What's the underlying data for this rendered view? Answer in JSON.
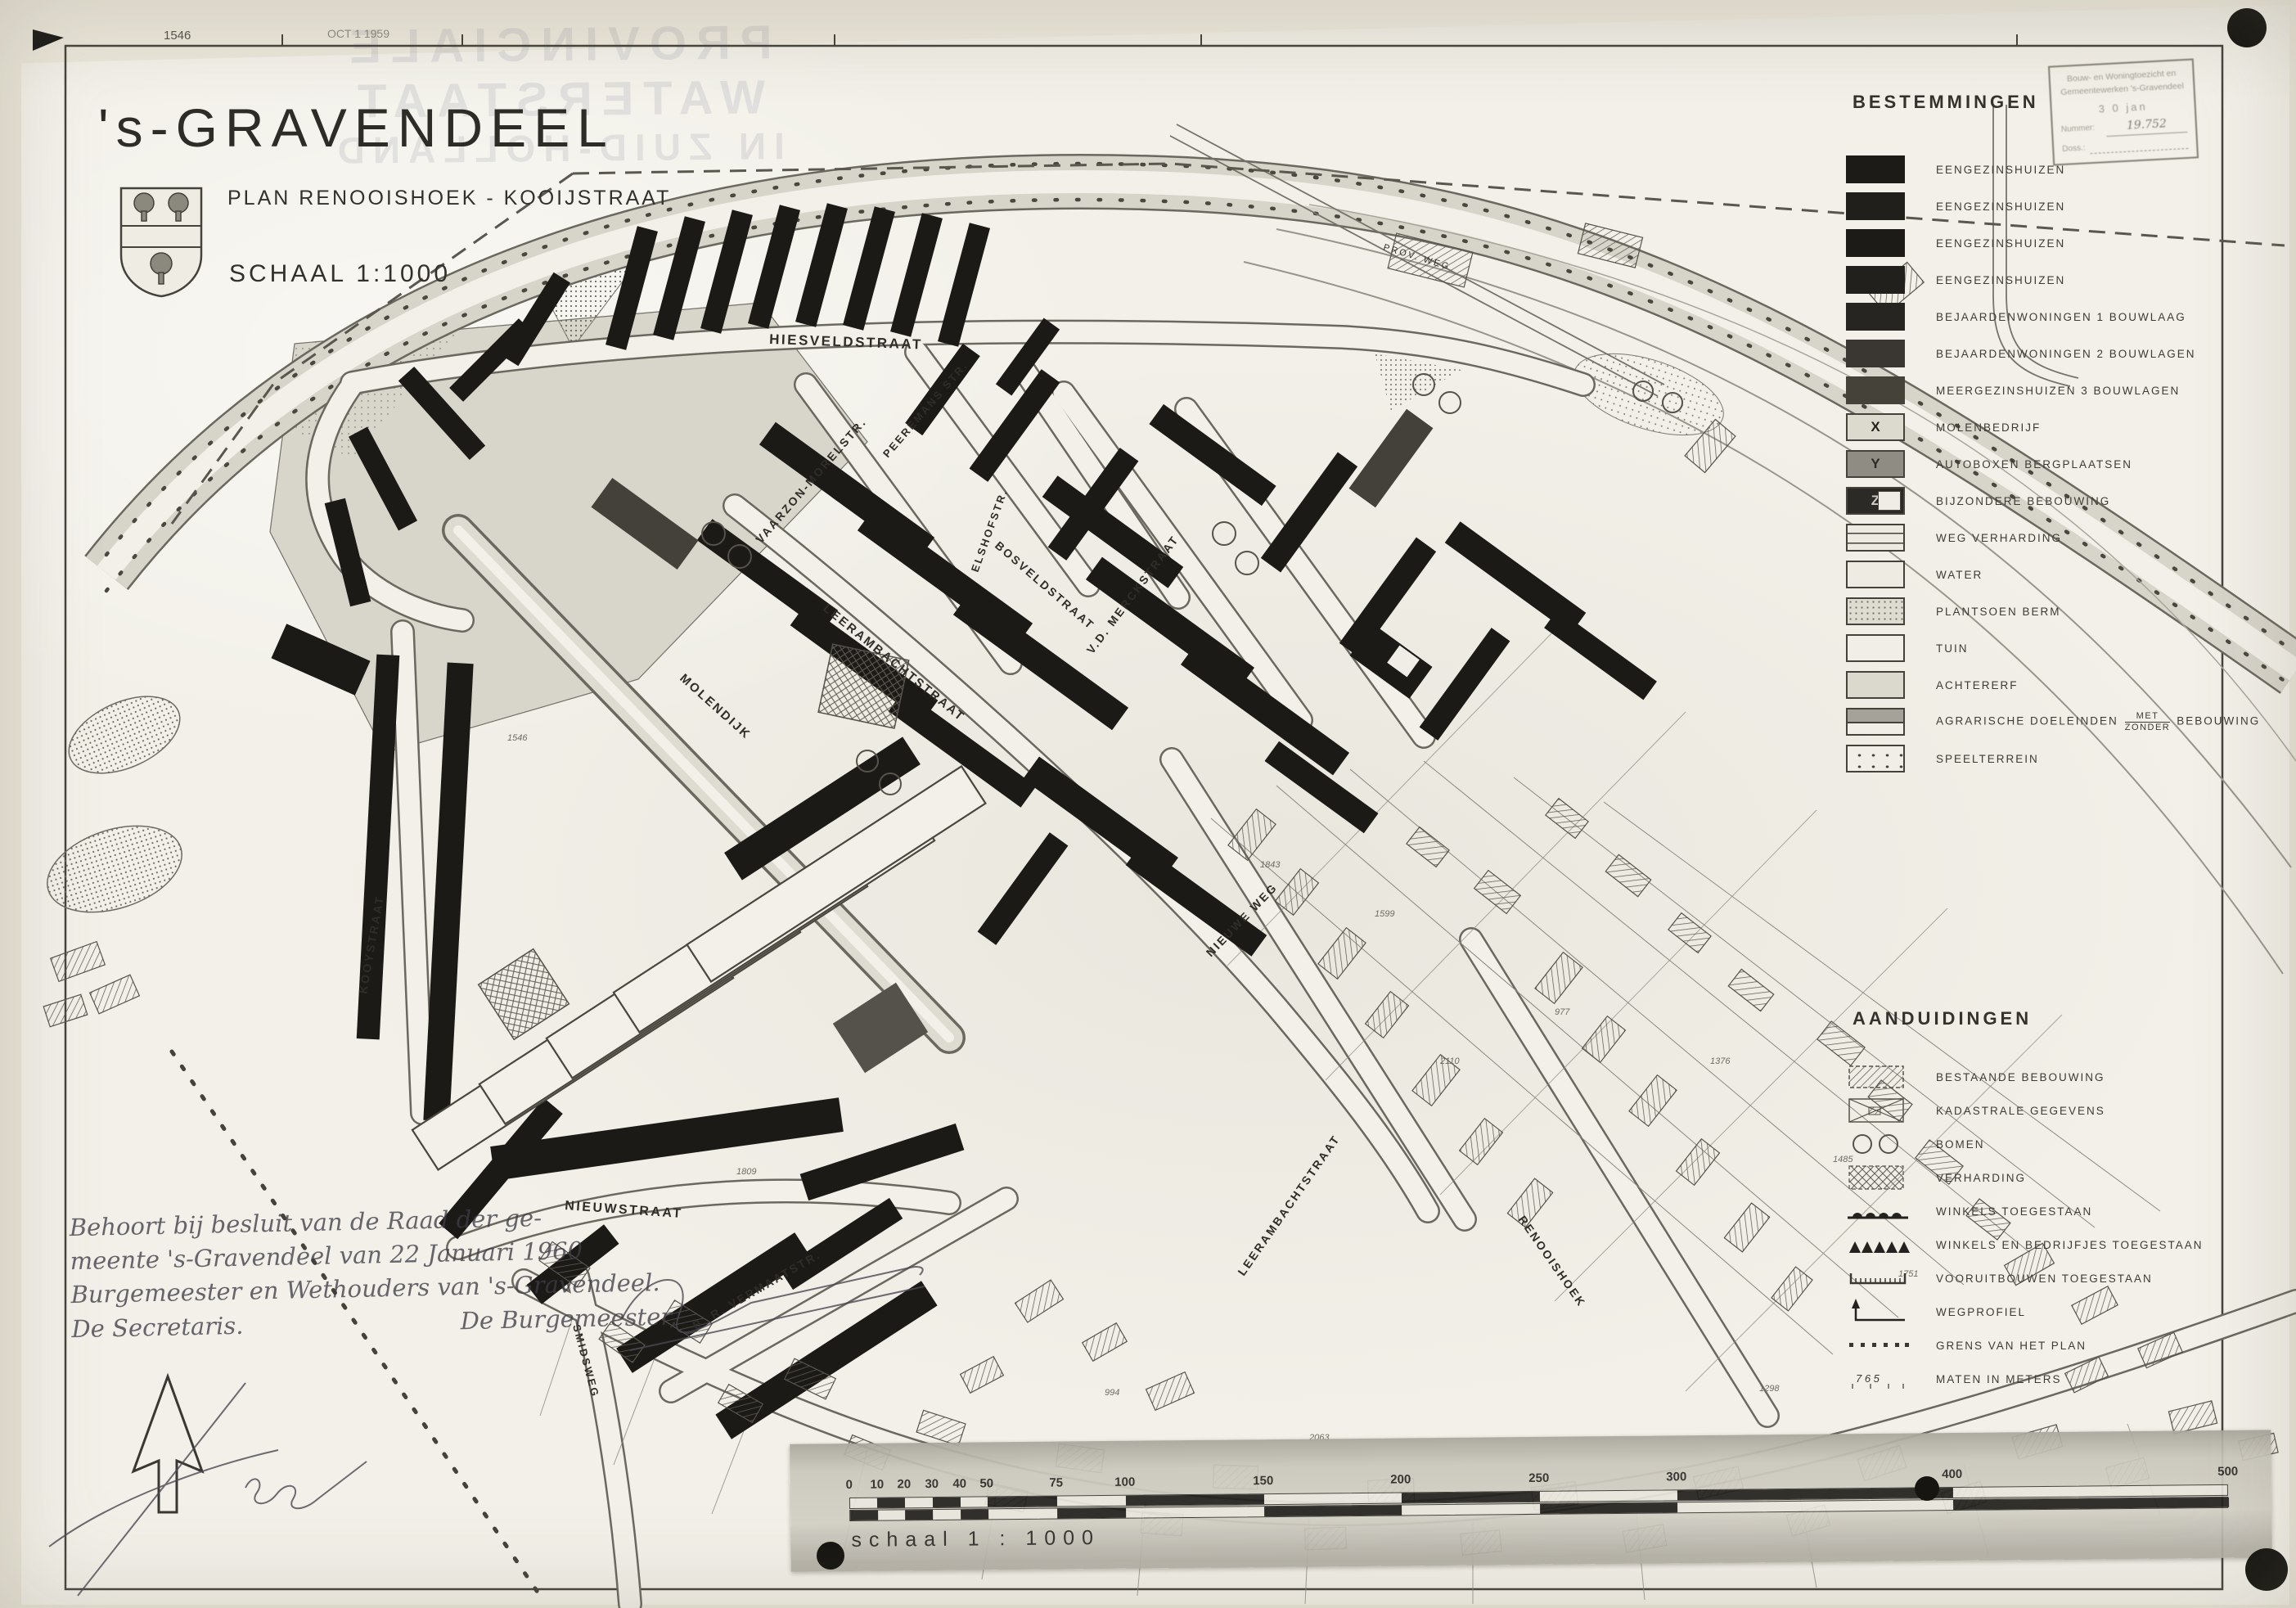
{
  "title_block": {
    "town": "'s-GRAVENDEEL",
    "plan": "PLAN RENOOISHOEK - KOOIJSTRAAT",
    "scale": "SCHAAL 1:1000"
  },
  "sheet_marks": {
    "ref": "1546",
    "date": "OCT 1 1959"
  },
  "ghost_text": {
    "line1": "PROVINCIALE WATERSTAAT",
    "line2": "IN ZUID-HOLLAND"
  },
  "stamp": {
    "line1": "Bouw- en Woningtoezicht en",
    "line2": "Gemeentewerken 's-Gravendeel",
    "date": "3 0 jan",
    "number_label": "Nummer:",
    "number": "19.752",
    "doss_label": "Doss.:"
  },
  "legend_bestemmingen": {
    "title": "BESTEMMINGEN",
    "items": [
      {
        "label": "EENGEZINSHUIZEN"
      },
      {
        "label": "EENGEZINSHUIZEN"
      },
      {
        "label": "EENGEZINSHUIZEN"
      },
      {
        "label": "EENGEZINSHUIZEN"
      },
      {
        "label": "BEJAARDENWONINGEN  1 BOUWLAAG"
      },
      {
        "label": "BEJAARDENWONINGEN  2 BOUWLAGEN"
      },
      {
        "label": "MEERGEZINSHUIZEN   3 BOUWLAGEN"
      },
      {
        "label": "MOLENBEDRIJF",
        "tag": "X"
      },
      {
        "label": "AUTOBOXEN  BERGPLAATSEN",
        "tag": "Y"
      },
      {
        "label": "BIJZONDERE  BEBOUWING",
        "tag": "Z"
      },
      {
        "label": "WEG  VERHARDING"
      },
      {
        "label": "WATER"
      },
      {
        "label": "PLANTSOEN  BERM"
      },
      {
        "label": "TUIN"
      },
      {
        "label": "ACHTERERF"
      },
      {
        "label": "AGRARISCHE  DOELEINDEN",
        "fraction_top": "MET",
        "fraction_bottom": "ZONDER",
        "suffix": "BEBOUWING"
      },
      {
        "label": "SPEELTERREIN"
      }
    ]
  },
  "legend_aanduidingen": {
    "title": "AANDUIDINGEN",
    "items": [
      {
        "label": "BESTAANDE  BEBOUWING"
      },
      {
        "label": "KADASTRALE  GEGEVENS"
      },
      {
        "label": "BOMEN"
      },
      {
        "label": "VERHARDING"
      },
      {
        "label": "WINKELS  TOEGESTAAN"
      },
      {
        "label": "WINKELS   EN BEDRIJFJES  TOEGESTAAN"
      },
      {
        "label": "VOORUITBOUWEN  TOEGESTAAN"
      },
      {
        "label": "WEGPROFIEL"
      },
      {
        "label": "GRENS  VAN  HET  PLAN"
      },
      {
        "label": "MATEN  IN  METERS",
        "ticks": "7  6  5"
      }
    ]
  },
  "streets": {
    "hiesveld": "HIESVELDSTRAAT",
    "vaarzon": "VAARZON-MORELSTR.",
    "peeremans": "PEEREMANS STR.",
    "elshof": "ELSHOFSTR.",
    "bosveld": "BOSVELDSTRAAT",
    "vdmerck": "V.D. MERCKSTRAAT",
    "leerambacht": "LEERAMBACHTSTRAAT",
    "leerambacht2": "LEERAMBACHTSTRAAT",
    "molendijk": "MOLENDIJK",
    "kooystraat": "KOOYSTRAAT",
    "nieuwstraat": "NIEUWSTRAAT",
    "vermaat": "B. R. VERMAATSTR.",
    "nieuweweg": "NIEUWE WEG",
    "renooishoek": "RENOOISHOEK",
    "smidsweg": "SMIDSWEG",
    "provweg": "PROV. WEG"
  },
  "parcel_numbers": [
    "1843",
    "1599",
    "2110",
    "977",
    "1376",
    "1485",
    "994",
    "2063",
    "1298",
    "1809",
    "1546",
    "1751"
  ],
  "note": {
    "line1": "Behoort bij besluit van de Raad der ge-",
    "line2": "meente 's-Gravendeel van 22 Januari 1960",
    "line3": "Burgemeester en Wethouders van 's-Gravendeel.",
    "left_sig": "De Secretaris.",
    "right_sig": "De Burgemeester,"
  },
  "scalebar": {
    "caption": "schaal   1 : 1000",
    "ticks": [
      "0",
      "10",
      "20",
      "30",
      "40",
      "50",
      "75",
      "100",
      "150",
      "200",
      "250",
      "300",
      "400",
      "500"
    ]
  },
  "colors": {
    "ink": "#3a3732",
    "building": "#1b1a16",
    "paper": "#f2f0e8",
    "photo_margin": "#e9e5d8"
  }
}
